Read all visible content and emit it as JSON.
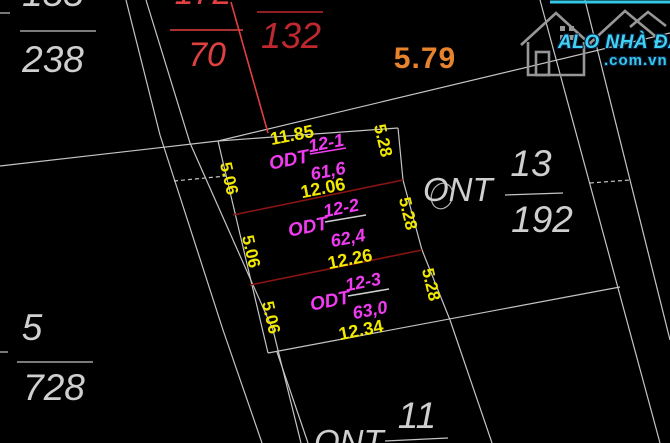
{
  "brand": {
    "name": "ALO NHÀ ĐẤT",
    "domain": ".com.vn"
  },
  "frontage_note": "5.79",
  "parcels": {
    "p155": {
      "num": "155",
      "den": "238"
    },
    "p172": {
      "num": "172",
      "den": "70"
    },
    "p132": {
      "den": "132"
    },
    "p201": {
      "label": "201"
    },
    "ont13": {
      "use": "ONT",
      "num": "13",
      "den": "192"
    },
    "p5": {
      "num": "5",
      "den": "728"
    },
    "ont11": {
      "use": "ONT",
      "num": "11"
    }
  },
  "plots": [
    {
      "name": "12-1",
      "use": "ODT",
      "area": "61,6",
      "top": "11.85",
      "bottom": "12.06",
      "left": "5.06",
      "right": "5.28"
    },
    {
      "name": "12-2",
      "use": "ODT",
      "area": "62,4",
      "bottom": "12.26",
      "left": "5.06",
      "right": "5.28"
    },
    {
      "name": "12-3",
      "use": "ODT",
      "area": "63,0",
      "bottom": "12.34",
      "left": "5.06",
      "right": "5.28"
    }
  ],
  "colors": {
    "background": "#000000",
    "boundary_gray": "#c4c4c4",
    "dimension_yellow": "#f2e800",
    "plot_magenta": "#f03cf0",
    "leader_red": "#e04040",
    "parcel_132_red": "#c02830",
    "divider_red": "#8a1414",
    "frontage_orange": "#e8832d",
    "brand_cyan": "#35c8e8"
  }
}
